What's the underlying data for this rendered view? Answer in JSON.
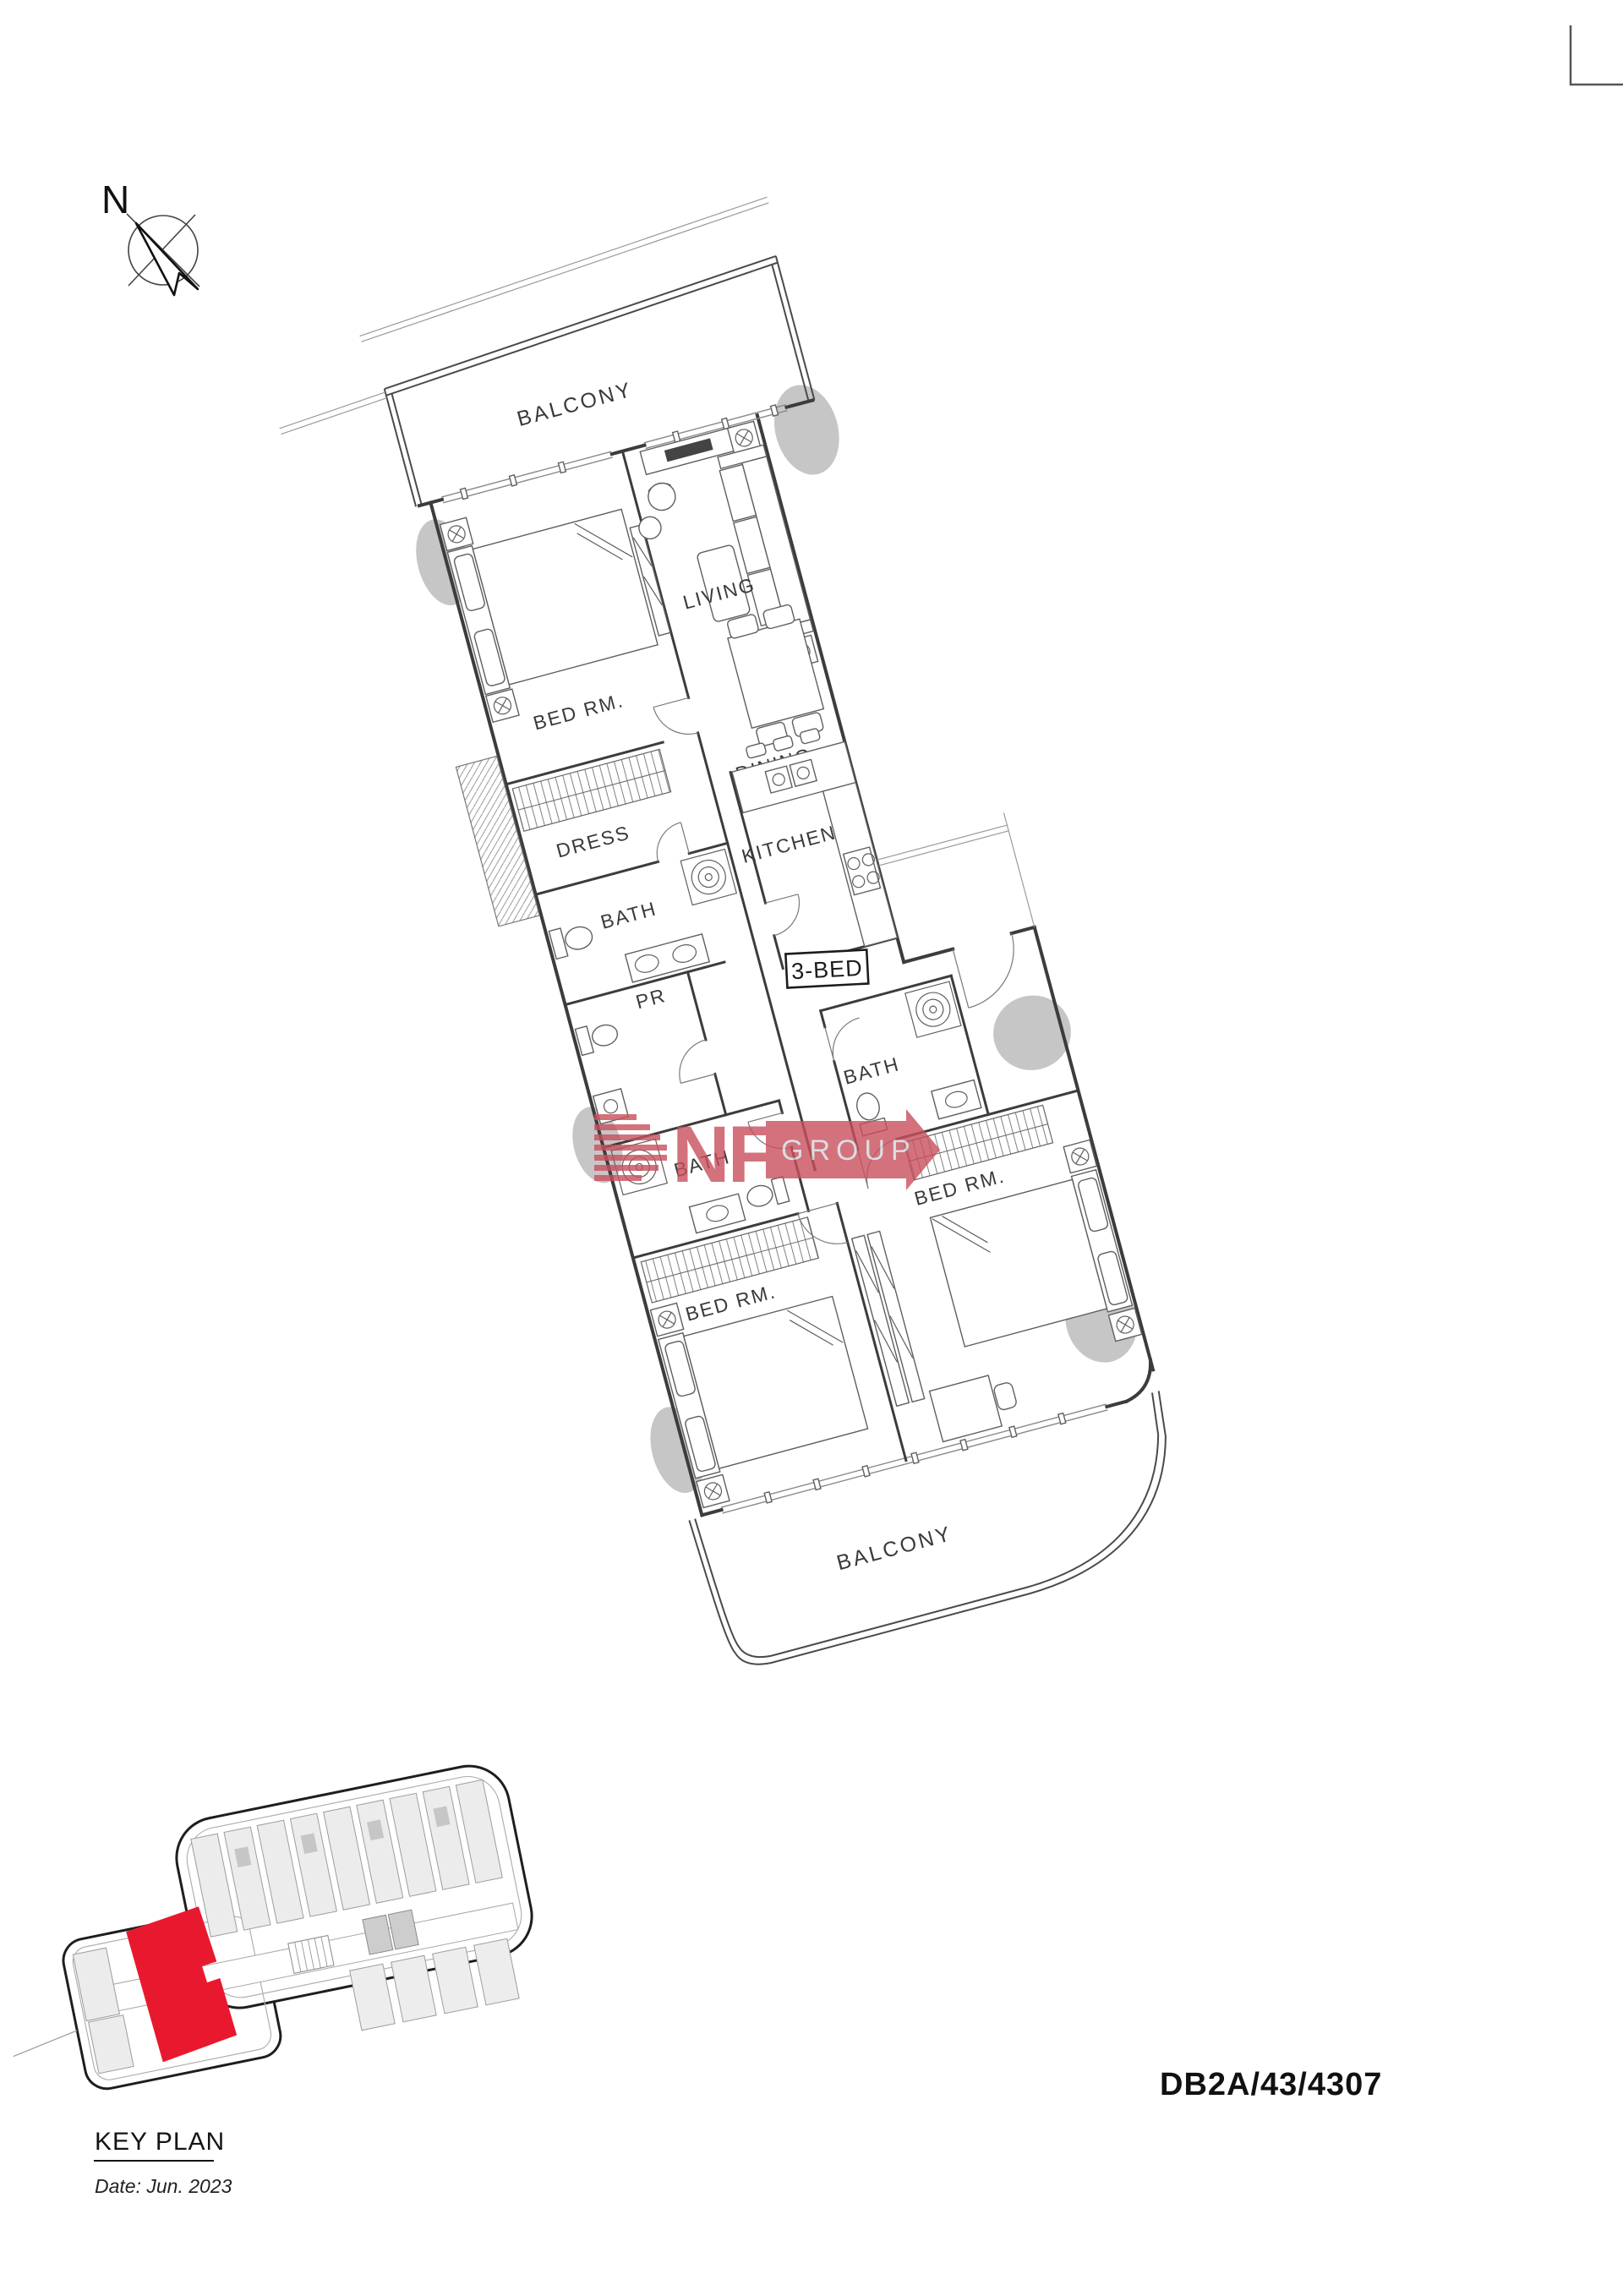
{
  "document": {
    "reference_number": "DB2A/43/4307",
    "key_plan_title": "KEY PLAN",
    "date_note": "Date: Jun. 2023"
  },
  "compass": {
    "north_label": "N"
  },
  "floor_plan": {
    "unit_type_label": "3-BED",
    "labels": {
      "balcony_top": "BALCONY",
      "bed_master": "BED RM.",
      "living": "LIVING",
      "dining": "DINING",
      "dress": "DRESS",
      "kitchen": "KITCHEN",
      "bath_master": "BATH",
      "powder_room": "PR",
      "bath_left": "BATH",
      "bath_right": "BATH",
      "bed_left": "BED RM.",
      "bed_right": "BED RM.",
      "balcony_bottom": "BALCONY"
    }
  },
  "watermark": {
    "letters": "NF",
    "banner_text": "GROUP",
    "red": "#c94f5c",
    "banner_text_color": "#d3d6da"
  },
  "key_plan": {
    "highlight_color": "#e8192e"
  },
  "colors": {
    "wall": "#3c3c3c",
    "column_gray": "#c6c6c6",
    "keyplan_outline": "#1e1e1e"
  }
}
